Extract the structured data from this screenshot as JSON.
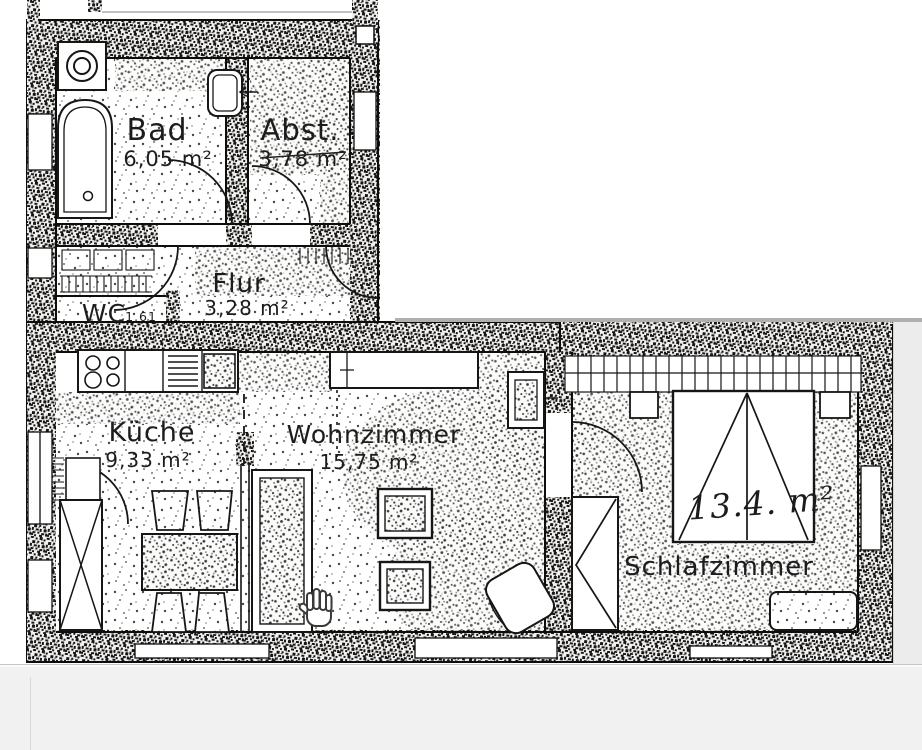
{
  "viewer": {
    "page_background": "#ffffff",
    "panel_background": "#f1f1f2",
    "seam_color": "#b0b0b0",
    "right_margin_color": "#ececec",
    "ink_color": "#1f1f1f"
  },
  "floor_plan": {
    "type": "scanned-apartment-floor-plan",
    "language": "German",
    "rooms": [
      {
        "name": "Bad",
        "area": "6,05 m²"
      },
      {
        "name": "Abst.",
        "area": "3,78 m²"
      },
      {
        "name": "Flur",
        "area": "3,28 m²"
      },
      {
        "name": "WC",
        "area": "1,61"
      },
      {
        "name": "Küche",
        "area": "9,33 m²"
      },
      {
        "name": "Wohnzimmer",
        "area": "15,75 m²"
      },
      {
        "name": "Schlafzimmer",
        "area": "13.4. m²",
        "style": "handwritten"
      }
    ]
  },
  "cursor": {
    "type": "open-hand-pan-cursor"
  }
}
